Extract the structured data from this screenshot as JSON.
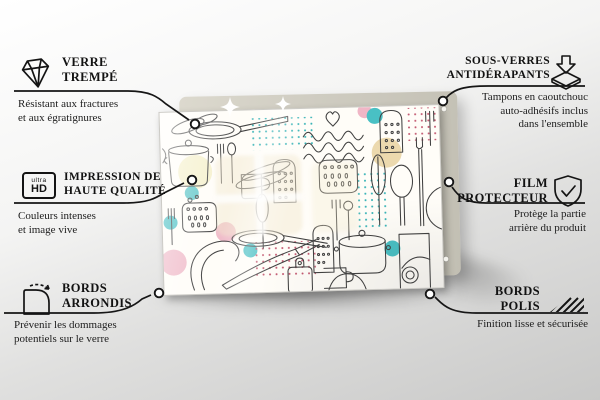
{
  "scene": {
    "type": "product-feature-infographic",
    "language": "fr",
    "colors": {
      "text": "#141414",
      "backing_board": "#cfccc1",
      "glass_background": "#fffdf8",
      "line_art": "#404040",
      "accent_teal": "#49c0c4",
      "accent_pink": "#f0b6c6",
      "accent_yellow": "#f5f0cb",
      "accent_beige": "#ecd9ae",
      "accent_red_dots": "#c2556e"
    }
  },
  "product": {
    "name": "glass-board-with-kitchen-doodle-pattern",
    "pattern": "kitchen utensils line-art doodle (pans, pots, graters, spoons, forks, jars, mugs, dotted squares, pastel circles)"
  },
  "callouts": [
    {
      "id": "verre-trempe",
      "icon": "diamond-icon",
      "title": [
        "VERRE",
        "TREMPÉ"
      ],
      "desc": [
        "Résistant aux fractures",
        "et aux égratignures"
      ]
    },
    {
      "id": "impression-haute-qualite",
      "icon": "ultra-hd-icon",
      "icon_text": {
        "small": "ultra",
        "big": "HD"
      },
      "title": [
        "IMPRESSION DE",
        "HAUTE QUALITÉ"
      ],
      "desc": [
        "Couleurs intenses",
        "et image vive"
      ]
    },
    {
      "id": "bords-arrondis",
      "icon": "rounded-corner-icon",
      "title": [
        "BORDS",
        "ARRONDIS"
      ],
      "desc": [
        "Prévenir les dommages",
        "potentiels sur le verre"
      ]
    },
    {
      "id": "sous-verres-antiderapants",
      "icon": "non-slip-pads-icon",
      "title": [
        "SOUS-VERRES",
        "ANTIDÉRAPANTS"
      ],
      "desc": [
        "Tampons en caoutchouc",
        "auto-adhésifs inclus",
        "dans l'ensemble"
      ]
    },
    {
      "id": "film-protecteur",
      "icon": "shield-check-icon",
      "title": [
        "FILM",
        "PROTECTEUR"
      ],
      "desc": [
        "Protège la partie",
        "arrière du produit"
      ]
    },
    {
      "id": "bords-polis",
      "icon": "polished-edges-icon",
      "title": [
        "BORDS",
        "POLIS"
      ],
      "desc": [
        "Finition lisse et sécurisée"
      ]
    }
  ]
}
